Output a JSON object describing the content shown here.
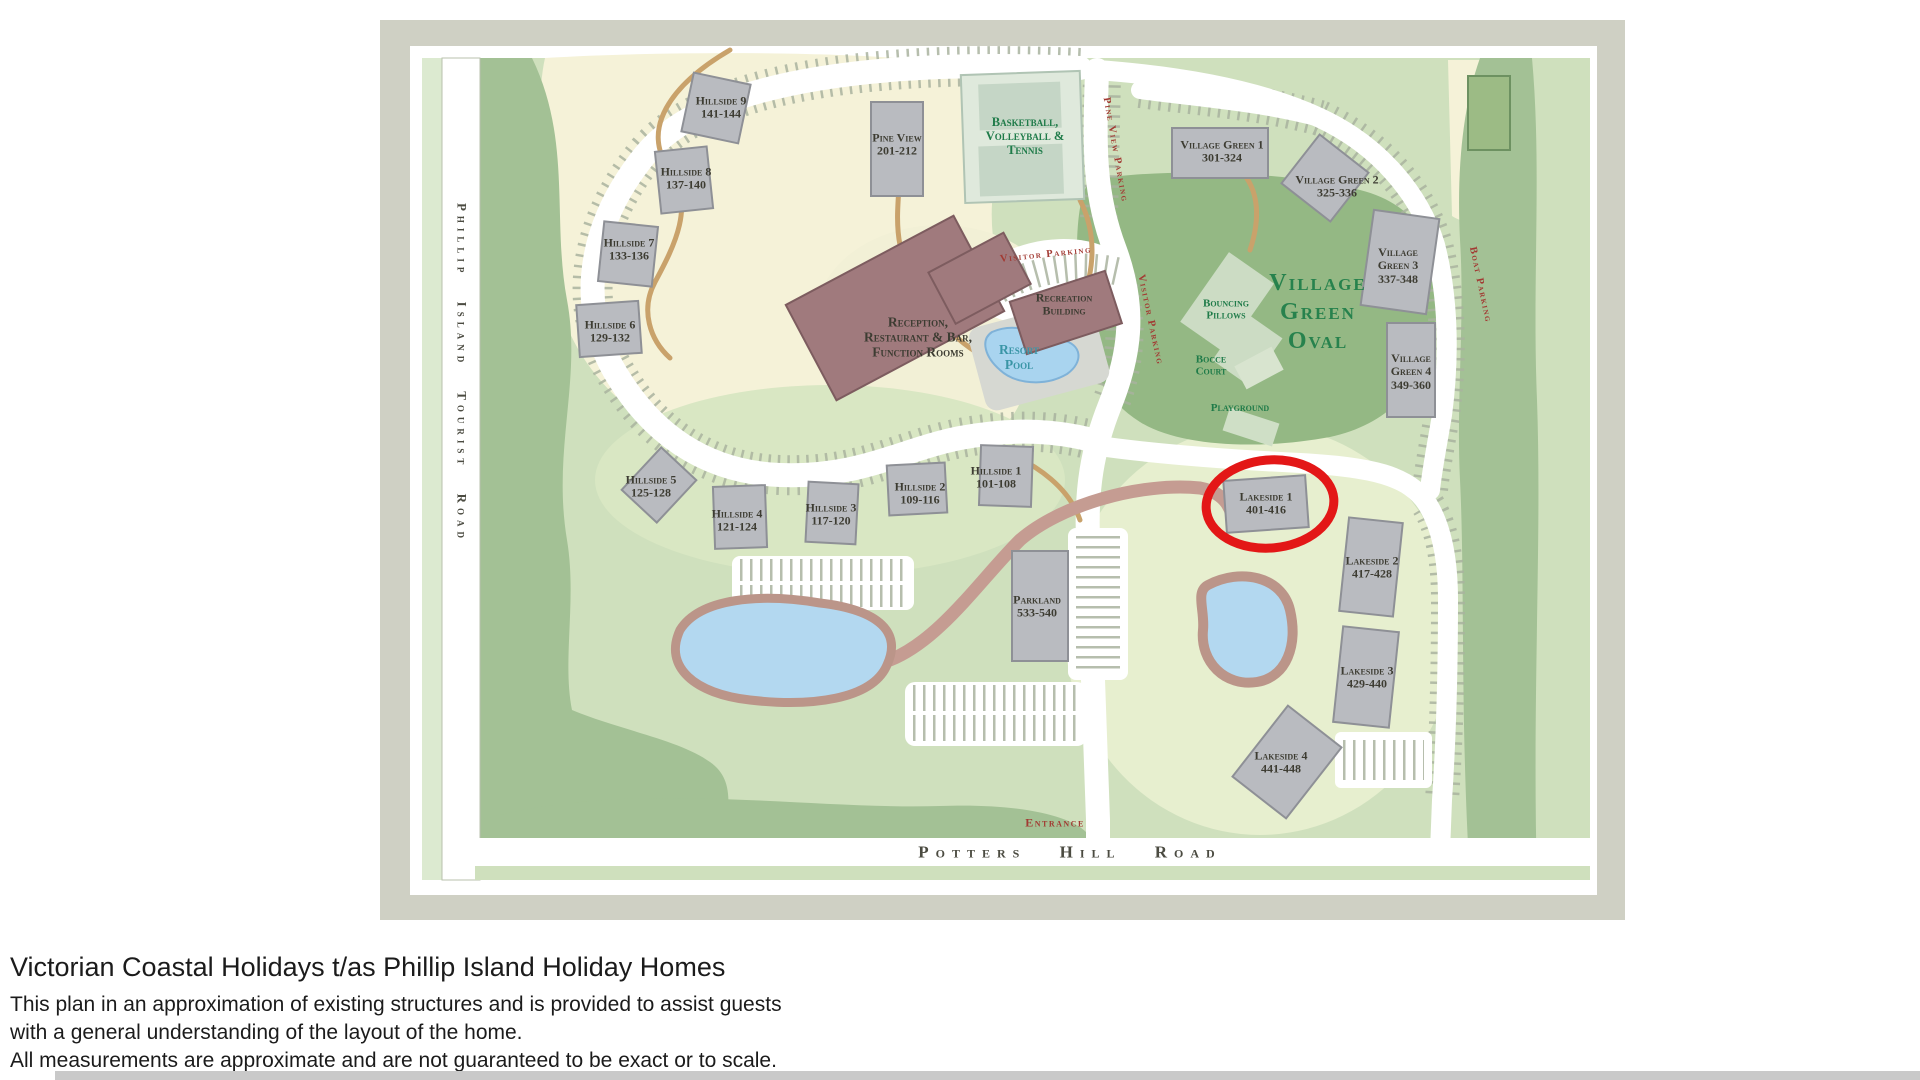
{
  "map_labels": {
    "hillside9": {
      "lines": [
        "Hillside 9",
        "141-144"
      ]
    },
    "hillside8": {
      "lines": [
        "Hillside 8",
        "137-140"
      ]
    },
    "hillside7": {
      "lines": [
        "Hillside 7",
        "133-136"
      ]
    },
    "hillside6": {
      "lines": [
        "Hillside 6",
        "129-132"
      ]
    },
    "hillside5": {
      "lines": [
        "Hillside 5",
        "125-128"
      ]
    },
    "hillside4": {
      "lines": [
        "Hillside 4",
        "121-124"
      ]
    },
    "hillside3": {
      "lines": [
        "Hillside 3",
        "117-120"
      ]
    },
    "hillside2": {
      "lines": [
        "Hillside 2",
        "109-116"
      ]
    },
    "hillside1": {
      "lines": [
        "Hillside 1",
        "101-108"
      ]
    },
    "pine_view": {
      "lines": [
        "Pine View",
        "201-212"
      ]
    },
    "reception": {
      "lines": [
        "Reception,",
        "Restaurant & Bar,",
        "Function Rooms"
      ]
    },
    "recreation_building": {
      "lines": [
        "Recreation",
        "Building"
      ]
    },
    "village_green1": {
      "lines": [
        "Village Green 1",
        "301-324"
      ]
    },
    "village_green2": {
      "lines": [
        "Village Green 2",
        "325-336"
      ]
    },
    "village_green3": {
      "lines": [
        "Village",
        "Green 3",
        "337-348"
      ]
    },
    "village_green4": {
      "lines": [
        "Village",
        "Green 4",
        "349-360"
      ]
    },
    "lakeside1": {
      "lines": [
        "Lakeside 1",
        "401-416"
      ]
    },
    "lakeside2": {
      "lines": [
        "Lakeside 2",
        "417-428"
      ]
    },
    "lakeside3": {
      "lines": [
        "Lakeside 3",
        "429-440"
      ]
    },
    "lakeside4": {
      "lines": [
        "Lakeside 4",
        "441-448"
      ]
    },
    "parkland": {
      "lines": [
        "Parkland",
        "533-540"
      ]
    },
    "basketball": {
      "lines": [
        "Basketball,",
        "Volleyball &",
        "Tennis"
      ]
    },
    "village_green_oval": {
      "lines": [
        "Village",
        "Green",
        "Oval"
      ]
    },
    "bouncing_pillows": {
      "lines": [
        "Bouncing",
        "Pillows"
      ]
    },
    "bocce_court": {
      "lines": [
        "Bocce",
        "Court"
      ]
    },
    "playground": {
      "lines": [
        "Playground"
      ]
    },
    "resort_pool": {
      "lines": [
        "Resort",
        "Pool"
      ]
    },
    "visitor_parking_top": {
      "lines": [
        "Visitor Parking"
      ]
    },
    "visitor_parking_side": {
      "lines": [
        "Visitor Parking"
      ]
    },
    "pine_view_parking": {
      "lines": [
        "Pine View Parking"
      ]
    },
    "boat_parking": {
      "lines": [
        "Boat Parking"
      ]
    },
    "entrance": {
      "lines": [
        "Entrance"
      ]
    },
    "potters_hill_road": {
      "lines": [
        "Potters Hill Road"
      ]
    },
    "phillip_island_tourist_road": {
      "lines": [
        "Phillip Island Tourist Road"
      ]
    }
  },
  "colors": {
    "map_border": "#cfd0c4",
    "map_base_green": "#cfe0bd",
    "cream": "#f5f2d8",
    "dark_green": "#a3c195",
    "oval_green": "#94b884",
    "building_grey": "#b9bbc0",
    "reception_burgundy": "#a07a7d",
    "water_blue": "#b3d8f0",
    "water_ring_brown": "#bb9589",
    "path_tan": "#c9a26b",
    "highlight_red": "#e31717",
    "label_green": "#1f7b49",
    "label_red": "#a23a33"
  },
  "footer": {
    "title": "Victorian Coastal Holidays t/as Phillip Island Holiday Homes",
    "lines": [
      "This plan in an approximation of existing structures and is provided to assist guests",
      "with a general understanding of the layout of the home.",
      "All measurements are approximate and are not guaranteed to be exact or to scale."
    ]
  }
}
